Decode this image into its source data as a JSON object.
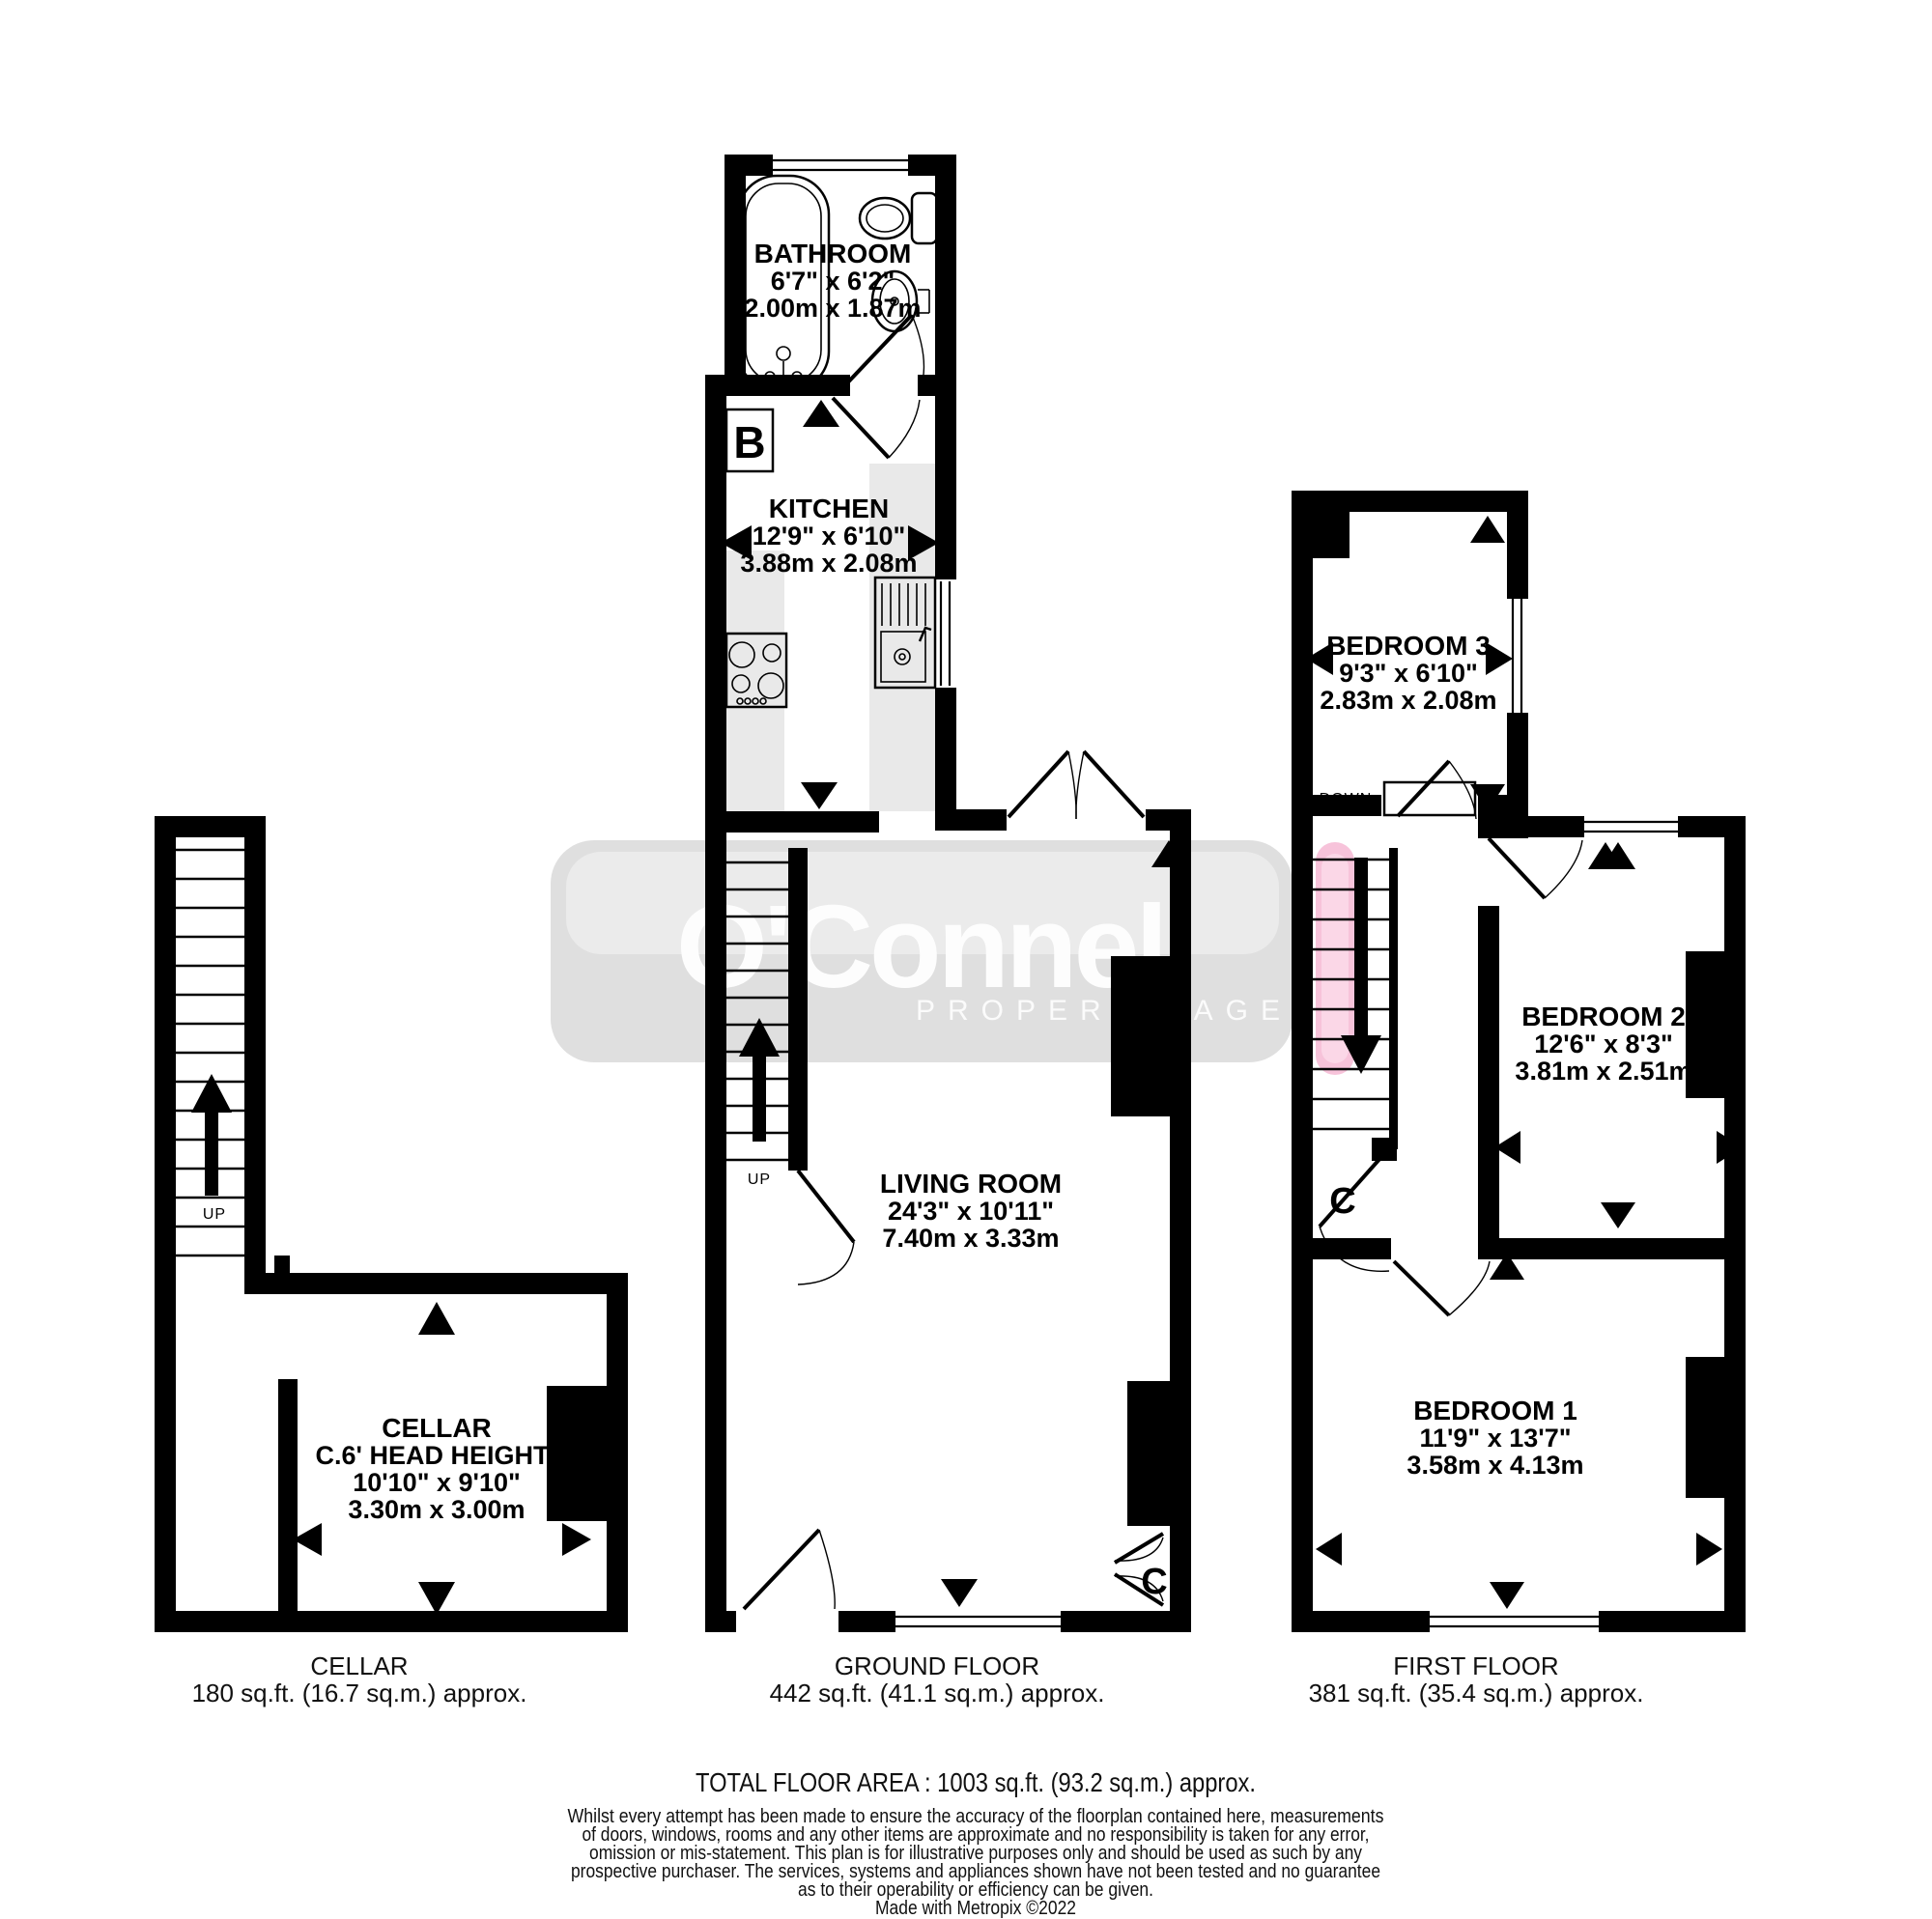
{
  "watermark": {
    "name": "O'Connell",
    "tagline": "PROPERTY AGENTS",
    "band_color": "#dfdfdf",
    "band_highlight": "#ebebeb",
    "pink_accent": "#f7c3da",
    "pink_highlight": "#fbd7e7"
  },
  "plans": {
    "cellar": {
      "room": {
        "name": "CELLAR",
        "note": "C.6' HEAD HEIGHT)",
        "imperial": "10'10\"  x 9'10\"",
        "metric": "3.30m  x 3.00m"
      },
      "stairs_label": "UP",
      "floor_label": "CELLAR",
      "floor_area": "180 sq.ft. (16.7 sq.m.) approx."
    },
    "ground": {
      "bathroom": {
        "name": "BATHROOM",
        "imperial": "6'7\"  x 6'2\"",
        "metric": "2.00m  x 1.87m"
      },
      "kitchen": {
        "name": "KITCHEN",
        "imperial": "12'9\"  x 6'10\"",
        "metric": "3.88m  x 2.08m"
      },
      "living": {
        "name": "LIVING ROOM",
        "imperial": "24'3\"  x 10'11\"",
        "metric": "7.40m  x 3.33m"
      },
      "boiler_label": "B",
      "cupboard_label": "C",
      "stairs_label": "UP",
      "floor_label": "GROUND FLOOR",
      "floor_area": "442 sq.ft. (41.1 sq.m.) approx."
    },
    "first": {
      "bedroom3": {
        "name": "BEDROOM 3",
        "imperial": "9'3\"  x 6'10\"",
        "metric": "2.83m  x 2.08m"
      },
      "bedroom2": {
        "name": "BEDROOM 2",
        "imperial": "12'6\"  x 8'3\"",
        "metric": "3.81m  x 2.51m"
      },
      "bedroom1": {
        "name": "BEDROOM 1",
        "imperial": "11'9\"  x 13'7\"",
        "metric": "3.58m  x 4.13m"
      },
      "stairs_label": "DOWN",
      "cupboard_label": "C",
      "floor_label": "FIRST FLOOR",
      "floor_area": "381 sq.ft. (35.4 sq.m.) approx."
    }
  },
  "footer": {
    "total": "TOTAL FLOOR AREA : 1003 sq.ft. (93.2 sq.m.) approx.",
    "disclaimer_lines": [
      "Whilst every attempt has been made to ensure the accuracy of the floorplan contained here, measurements",
      "of doors, windows, rooms and any other items are approximate and no responsibility is taken for any error,",
      "omission or mis-statement. This plan is for illustrative purposes only and should be used as such by any",
      "prospective purchaser. The services, systems and appliances shown have not been tested and no guarantee",
      "as to their operability or efficiency can be given."
    ],
    "credit": "Made with Metropix ©2022"
  }
}
